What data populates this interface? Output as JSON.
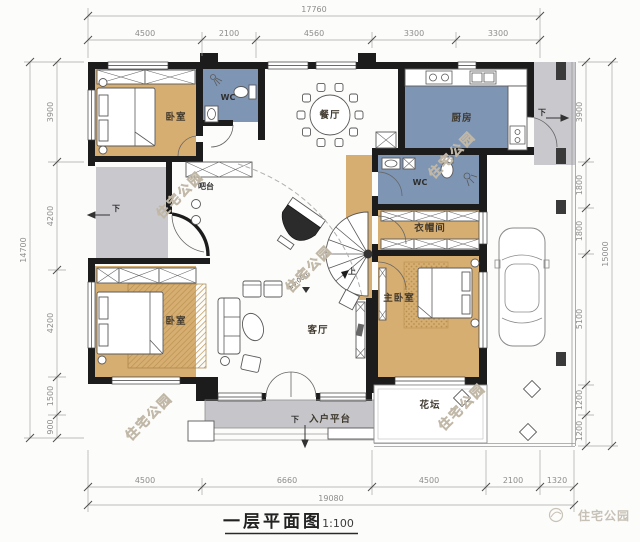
{
  "title": {
    "name": "一层平面图",
    "scale": "1:100"
  },
  "brand": {
    "name": "住宅公园"
  },
  "watermark": {
    "text": "住宅公园"
  },
  "rooms": {
    "bedroom_top_left": "卧室",
    "wc_top": "WC",
    "dining": "餐厅",
    "kitchen": "厨房",
    "bar": "吧台",
    "wc_middle": "WC",
    "cloakroom": "衣帽间",
    "bedroom_bottom_left": "卧室",
    "living": "客厅",
    "master_bedroom": "主卧室",
    "flower_bed": "花坛",
    "entry_platform": "入户平台"
  },
  "markers": {
    "up": "上",
    "down": "下",
    "level": "±0.000"
  },
  "dimensions": {
    "top": {
      "total": "17760",
      "segments": [
        "4500",
        "2100",
        "4560",
        "3300",
        "3300"
      ]
    },
    "bottom": {
      "total": "19080",
      "segments": [
        "4500",
        "6660",
        "4500",
        "2100",
        "1320"
      ]
    },
    "left": {
      "total": "14700",
      "segments": [
        "3900",
        "4200",
        "4200",
        "1500",
        "900"
      ]
    },
    "right": {
      "total": "15000",
      "segments": [
        "3900",
        "1800",
        "1800",
        "5100",
        "1200",
        "1200"
      ]
    }
  },
  "colors": {
    "floor_warm": "#d7ae72",
    "floor_blue": "#7e95b4",
    "porch": "#c9c9cd",
    "platform": "#c6c6ca",
    "wall": "#1c1c1c"
  }
}
